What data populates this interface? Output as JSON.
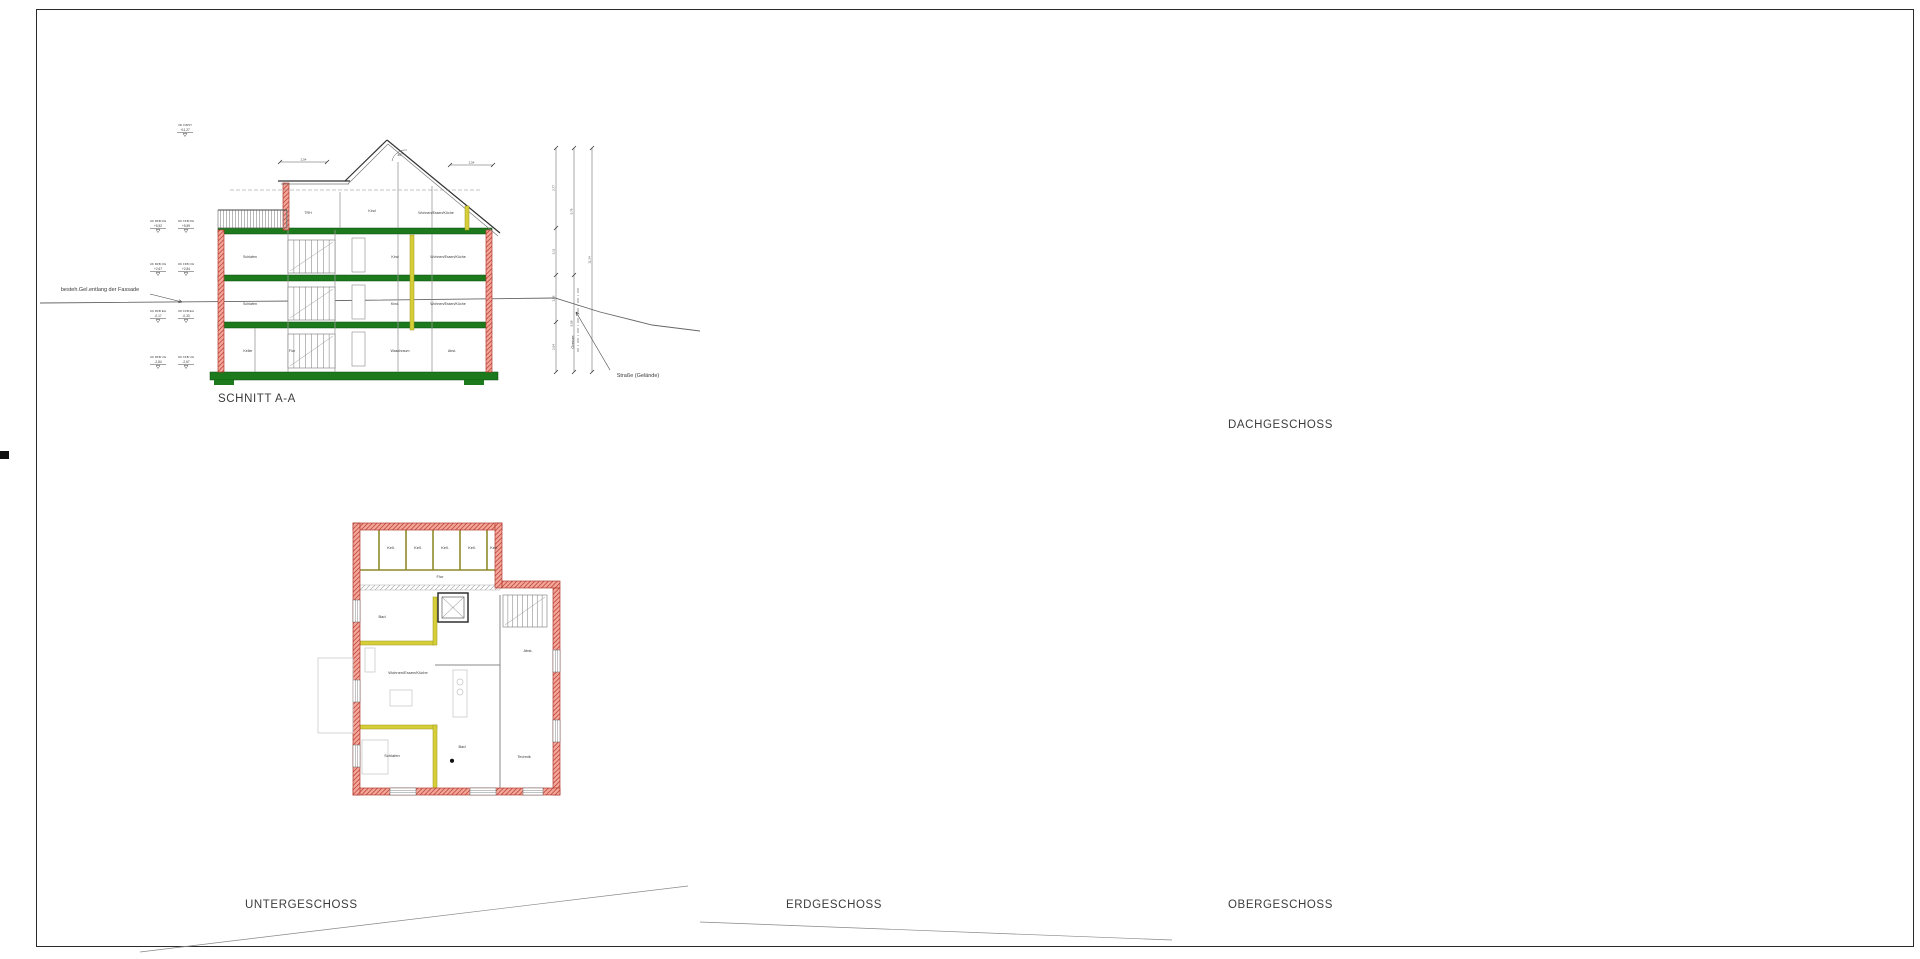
{
  "titles": {
    "schnitt": "SCHNITT A-A",
    "untergeschoss": "UNTERGESCHOSS",
    "erdgeschoss": "ERDGESCHOSS",
    "obergeschoss": "OBERGESCHOSS",
    "dachgeschoss": "DACHGESCHOSS"
  },
  "compass": {
    "north_label": "N"
  },
  "schnitt": {
    "annotations": {
      "ground": "besteh.Gel.entlang der Fassade",
      "street": "Straße (Gelände)",
      "boundary": "Grenze"
    },
    "elevation_marks": [
      {
        "label": "OK FIRST",
        "value": "+11,27"
      },
      {
        "label": "UK RFB DG",
        "value": "+5,52",
        "label2": "OK FFB DG",
        "value2": "+5,59"
      },
      {
        "label": "UK RFB OG",
        "value": "+2,67",
        "label2": "OK FFB OG",
        "value2": "+2,84"
      },
      {
        "label": "UK RFB EG",
        "value": "-0,17",
        "label2": "OK FFB EG",
        "value2": "-0,33"
      },
      {
        "label": "UK RFB UG",
        "value": "-2,84",
        "label2": "OK FFB UG",
        "value2": "-2,67"
      }
    ],
    "rooms": [
      {
        "label": "TRH",
        "x": 308,
        "y": 214
      },
      {
        "label": "Kind",
        "x": 372,
        "y": 212
      },
      {
        "label": "Wohnen/Essen/Küche",
        "x": 436,
        "y": 214
      },
      {
        "label": "Schlafen",
        "x": 250,
        "y": 258
      },
      {
        "label": "Kind",
        "x": 395,
        "y": 258
      },
      {
        "label": "Wohnen/Essen/Küche",
        "x": 448,
        "y": 258
      },
      {
        "label": "Schlafen",
        "x": 250,
        "y": 305
      },
      {
        "label": "Kind.",
        "x": 395,
        "y": 305
      },
      {
        "label": "Wohnen/Essen/Küche",
        "x": 448,
        "y": 305
      },
      {
        "label": "Keller",
        "x": 248,
        "y": 352
      },
      {
        "label": "Flur",
        "x": 292,
        "y": 352
      },
      {
        "label": "Waschraum",
        "x": 400,
        "y": 352
      },
      {
        "label": "Abst.",
        "x": 452,
        "y": 352
      }
    ],
    "dims": {
      "top_left": "2,54",
      "top_right": "2,54",
      "right": [
        "2,77",
        "3,11",
        "2,86",
        "2,64"
      ],
      "mid": [
        "5,75",
        "5,59"
      ],
      "total": "11,34",
      "roof_angle": "30°"
    }
  },
  "plans": {
    "untergeschoss": {
      "rooms": [
        {
          "label": "Kell.",
          "x": 391,
          "y": 549
        },
        {
          "label": "Kell.",
          "x": 418,
          "y": 549
        },
        {
          "label": "Kell.",
          "x": 445,
          "y": 549
        },
        {
          "label": "Kell.",
          "x": 472,
          "y": 549
        },
        {
          "label": "Kell.",
          "x": 494,
          "y": 549
        },
        {
          "label": "Flur",
          "x": 440,
          "y": 578
        },
        {
          "label": "Abst.",
          "x": 528,
          "y": 652
        },
        {
          "label": "Bad",
          "x": 382,
          "y": 618
        },
        {
          "label": "Wohnen/Essen/Küche",
          "x": 408,
          "y": 674
        },
        {
          "label": "Schlafen",
          "x": 392,
          "y": 757
        },
        {
          "label": "Bad",
          "x": 462,
          "y": 748
        },
        {
          "label": "Technik",
          "x": 524,
          "y": 758
        }
      ]
    },
    "erdgeschoss": {
      "rooms": [
        {
          "label": "Wohnen/Essen/Küche",
          "x": 917,
          "y": 578
        },
        {
          "label": "Zimmer",
          "x": 1000,
          "y": 556
        },
        {
          "label": "Flur",
          "x": 1012,
          "y": 621
        },
        {
          "label": "Bad",
          "x": 983,
          "y": 633
        },
        {
          "label": "Treppenhaus",
          "x": 1057,
          "y": 614
        },
        {
          "label": "Zimmer",
          "x": 947,
          "y": 690
        },
        {
          "label": "Bad",
          "x": 1003,
          "y": 688
        },
        {
          "label": "Flur",
          "x": 1028,
          "y": 688
        },
        {
          "label": "Abst.",
          "x": 1066,
          "y": 704
        },
        {
          "label": "Wohnen/Essen/Küche",
          "x": 952,
          "y": 743
        },
        {
          "label": "Zimmer",
          "x": 1062,
          "y": 768
        }
      ]
    },
    "obergeschoss": {
      "rooms": [
        {
          "label": "Wohnen/Essen/Küche",
          "x": 1362,
          "y": 578
        },
        {
          "label": "Zimmer",
          "x": 1445,
          "y": 556
        },
        {
          "label": "Bad",
          "x": 1428,
          "y": 633
        },
        {
          "label": "Flur",
          "x": 1458,
          "y": 620
        },
        {
          "label": "Treppenhaus",
          "x": 1500,
          "y": 614
        },
        {
          "label": "Zimmer",
          "x": 1390,
          "y": 690
        },
        {
          "label": "Bad",
          "x": 1448,
          "y": 690
        },
        {
          "label": "Flur",
          "x": 1472,
          "y": 695
        },
        {
          "label": "Abst.",
          "x": 1512,
          "y": 705
        },
        {
          "label": "Wohnen/Essen/Küche",
          "x": 1397,
          "y": 744
        },
        {
          "label": "Zimmer",
          "x": 1508,
          "y": 770
        }
      ]
    },
    "dachgeschoss": {
      "rooms": [
        {
          "label": "Wohnen/Essen/Küche",
          "x": 1360,
          "y": 199
        },
        {
          "label": "Bad",
          "x": 1425,
          "y": 187
        },
        {
          "label": "Flur",
          "x": 1455,
          "y": 178
        },
        {
          "label": "Zimmer",
          "x": 1505,
          "y": 209
        },
        {
          "label": "Zimmer",
          "x": 1363,
          "y": 234
        },
        {
          "label": "Abst.",
          "x": 1455,
          "y": 234
        },
        {
          "label": "Zimmer",
          "x": 1510,
          "y": 261
        },
        {
          "label": "Wohnen/Essen/Küche",
          "x": 1387,
          "y": 301
        },
        {
          "label": "Schlafen",
          "x": 1500,
          "y": 297
        }
      ]
    }
  },
  "site": {
    "parking_row": [
      "P7",
      "P6",
      "P5",
      "P4",
      "P3",
      "P2",
      "P1"
    ],
    "parking_lower": [
      "P9",
      "P8"
    ],
    "spielplatz": "SPIELPLATZ",
    "laterne": "Laterne",
    "ramp_note": "WD - 28,0m x 1%",
    "section_marker": "A"
  },
  "dims": {
    "top": [
      [
        "4,72",
        "1,13",
        "3,26",
        "1,13",
        "2,38"
      ],
      [
        "2,77",
        "1,38",
        "3,26",
        "1,38",
        "2,38"
      ],
      [
        "8,68",
        "3,63"
      ],
      [
        "9,30",
        "3,63"
      ]
    ],
    "bottom": [
      [
        "4,11",
        "1,38",
        "5,88"
      ],
      [
        "7,02",
        "4,30"
      ],
      [
        "12,36"
      ]
    ],
    "left": [
      [
        "1,50",
        "2,58",
        "1,96",
        "2,14",
        "3,00"
      ],
      [
        "5,86",
        "5,35"
      ],
      [
        "15,86"
      ]
    ],
    "right": [
      [
        "4,60",
        "1,01",
        "2,01",
        "1,51",
        "4,60"
      ],
      [
        "5,86",
        "5,35"
      ],
      [
        "15,86"
      ],
      [
        "12,21"
      ]
    ]
  },
  "colors": {
    "wall_red_fill": "#f3a79c",
    "wall_red_line": "#b03a2e",
    "wall_yellow": "#d6cf3a",
    "wall_yellow_line": "#9a9416",
    "slab_green": "#1c7a1c",
    "lawn": "#eaf6e6",
    "paving": "#ededed",
    "spielplatz_fill": "#f9f7c4"
  }
}
